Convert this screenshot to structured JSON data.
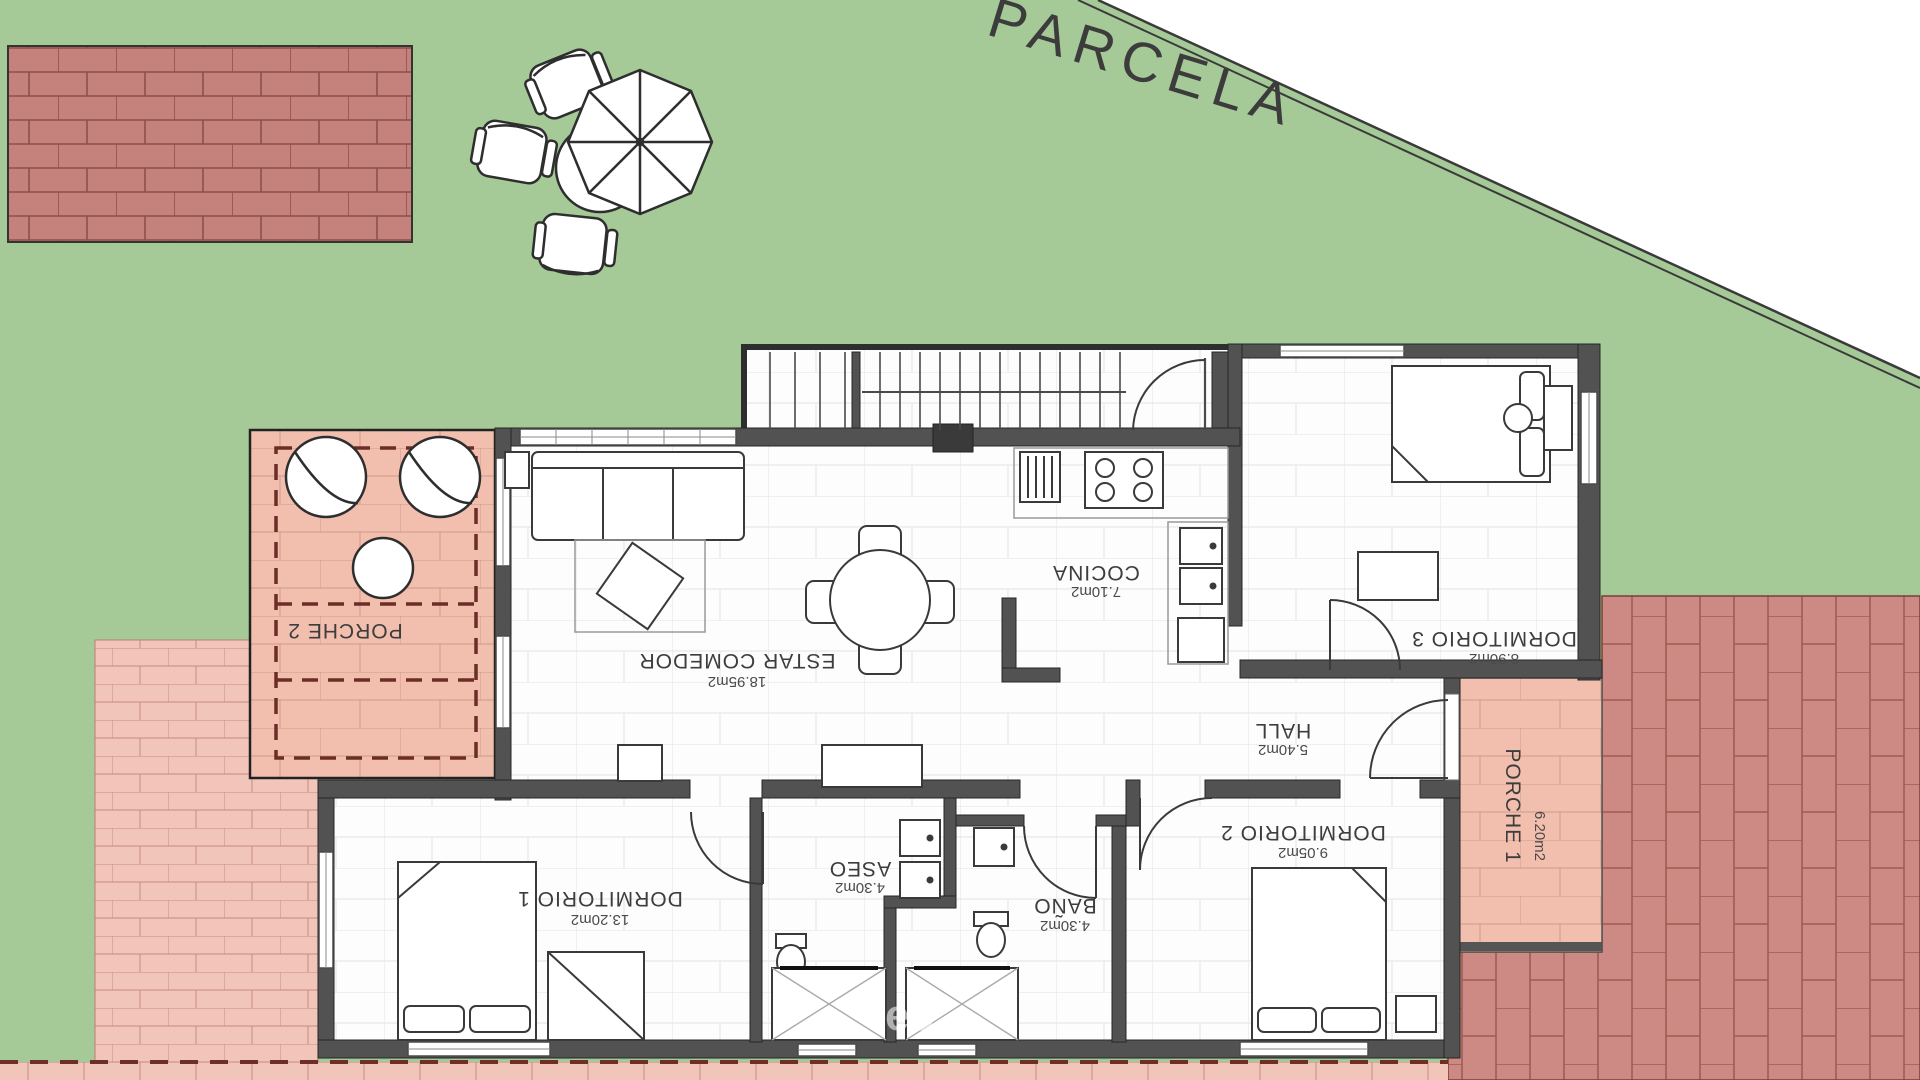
{
  "plan": {
    "parcel_label": "PARCELA",
    "watermark": "es",
    "rooms": [
      {
        "name": "ESTAR COMEDOR",
        "area": "18.95m2"
      },
      {
        "name": "COCINA",
        "area": "7.10m2"
      },
      {
        "name": "HALL",
        "area": "5.40m2"
      },
      {
        "name": "DORMITORIO 1",
        "area": "13.20m2"
      },
      {
        "name": "DORMITORIO 2",
        "area": "9.05m2"
      },
      {
        "name": "DORMITORIO 3",
        "area": "8.90m2"
      },
      {
        "name": "BAÑO",
        "area": "4.30m2"
      },
      {
        "name": "ASEO",
        "area": "4.30m2"
      },
      {
        "name": "PORCHE 1",
        "area": "6.20m2"
      },
      {
        "name": "PORCHE 2",
        "area": ""
      }
    ],
    "colors": {
      "lawn": "#a6ca97",
      "porch_salmon": "#f2bfae",
      "brick_patio": "#c5827d",
      "brick_light": "#f2c5ba",
      "brick_right": "#cd8a84",
      "wall_gray": "#525252",
      "boundary_band": "#ffffff"
    }
  }
}
